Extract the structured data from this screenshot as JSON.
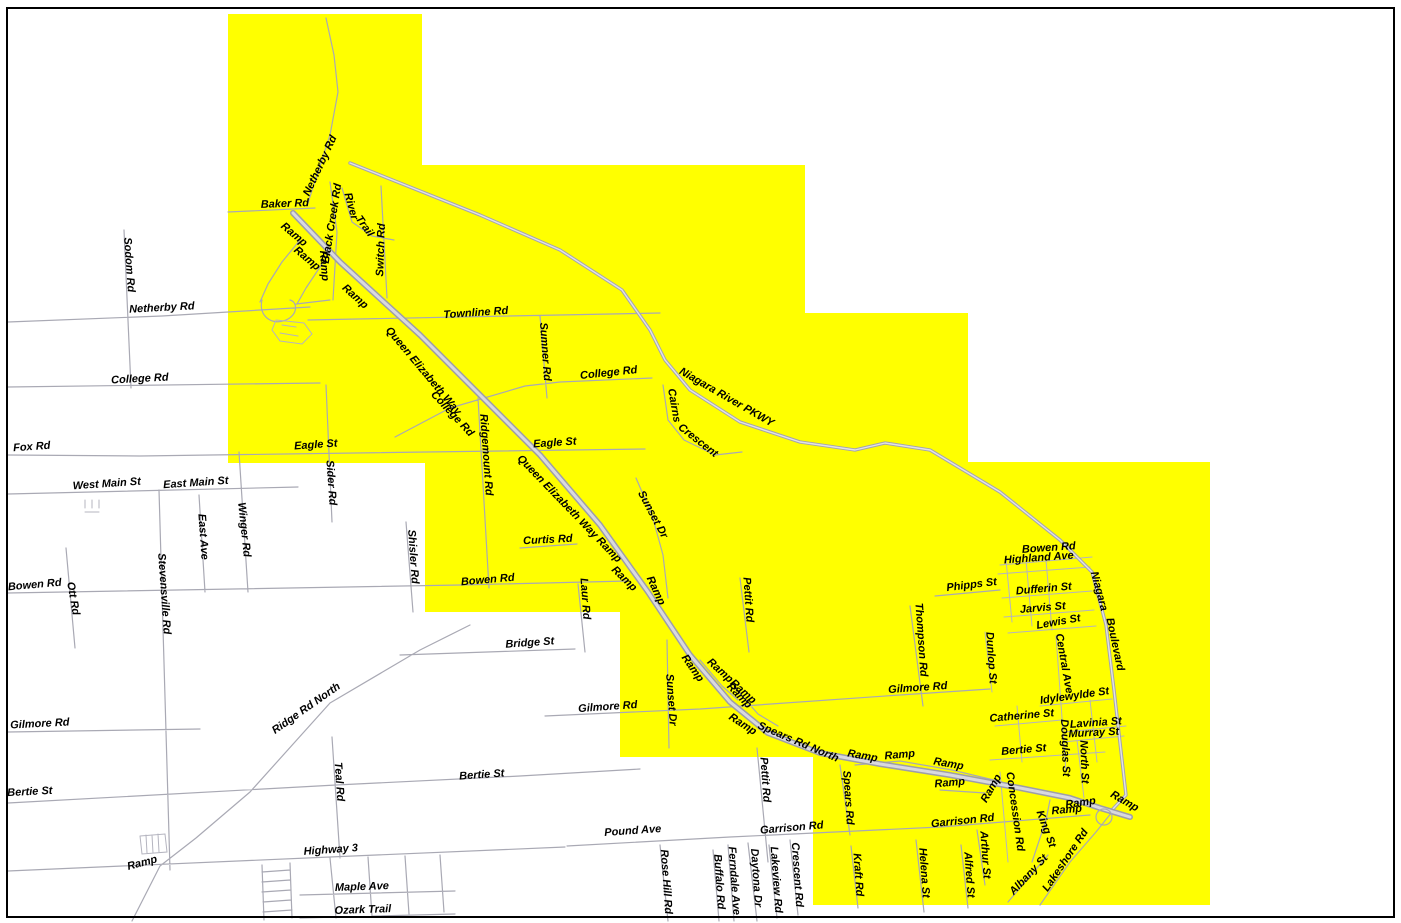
{
  "map": {
    "description": "Road map with highlighted service area",
    "colors": {
      "highlight": "#ffff00",
      "background": "#ffffff",
      "road": "#a9a9b4",
      "label": "#000000",
      "border": "#000000"
    },
    "highlight_polygon": [
      [
        228,
        14
      ],
      [
        422,
        14
      ],
      [
        422,
        165
      ],
      [
        805,
        165
      ],
      [
        805,
        313
      ],
      [
        968,
        313
      ],
      [
        968,
        462
      ],
      [
        1210,
        462
      ],
      [
        1210,
        905
      ],
      [
        813,
        905
      ],
      [
        813,
        757
      ],
      [
        620,
        757
      ],
      [
        620,
        612
      ],
      [
        425,
        612
      ],
      [
        425,
        463
      ],
      [
        228,
        463
      ]
    ],
    "labels": [
      {
        "text": "Netherby Rd",
        "x": 323,
        "y": 167,
        "rot": -65
      },
      {
        "text": "Baker Rd",
        "x": 285,
        "y": 207,
        "rot": -2
      },
      {
        "text": "Ramp",
        "x": 292,
        "y": 237,
        "rot": 40
      },
      {
        "text": "Ramp",
        "x": 305,
        "y": 261,
        "rot": 40
      },
      {
        "text": "Ramp",
        "x": 321,
        "y": 266,
        "rot": 86
      },
      {
        "text": "Ramp",
        "x": 353,
        "y": 299,
        "rot": 42
      },
      {
        "text": "Black Creek Rd",
        "x": 335,
        "y": 224,
        "rot": -81
      },
      {
        "text": "River",
        "x": 348,
        "y": 207,
        "rot": 75
      },
      {
        "text": "Trail",
        "x": 362,
        "y": 228,
        "rot": 55
      },
      {
        "text": "Switch Rd",
        "x": 384,
        "y": 250,
        "rot": -88
      },
      {
        "text": "Sodom Rd",
        "x": 126,
        "y": 265,
        "rot": 86
      },
      {
        "text": "Netherby Rd",
        "x": 162,
        "y": 311,
        "rot": -3
      },
      {
        "text": "Queen Elizabeth Way",
        "x": 421,
        "y": 373,
        "rot": 50
      },
      {
        "text": "Townline Rd",
        "x": 476,
        "y": 316,
        "rot": -4
      },
      {
        "text": "Sumner Rd",
        "x": 542,
        "y": 352,
        "rot": 86
      },
      {
        "text": "College Rd",
        "x": 140,
        "y": 382,
        "rot": -3
      },
      {
        "text": "College Rd",
        "x": 609,
        "y": 376,
        "rot": -6
      },
      {
        "text": "Niagara River PKWY",
        "x": 725,
        "y": 400,
        "rot": 30
      },
      {
        "text": "Cairns",
        "x": 671,
        "y": 406,
        "rot": 80
      },
      {
        "text": "Crescent",
        "x": 696,
        "y": 443,
        "rot": 38
      },
      {
        "text": "Eagle St",
        "x": 316,
        "y": 448,
        "rot": -4
      },
      {
        "text": "Fox Rd",
        "x": 32,
        "y": 450,
        "rot": -4
      },
      {
        "text": "West Main St",
        "x": 107,
        "y": 487,
        "rot": -4
      },
      {
        "text": "East Main St",
        "x": 196,
        "y": 486,
        "rot": -4
      },
      {
        "text": "Sider Rd",
        "x": 328,
        "y": 483,
        "rot": 86
      },
      {
        "text": "Winger Rd",
        "x": 241,
        "y": 530,
        "rot": 84
      },
      {
        "text": "East Ave",
        "x": 200,
        "y": 537,
        "rot": 86
      },
      {
        "text": "Stevensville Rd",
        "x": 161,
        "y": 594,
        "rot": 86
      },
      {
        "text": "Ott Rd",
        "x": 70,
        "y": 599,
        "rot": 80
      },
      {
        "text": "Bowen Rd",
        "x": 35,
        "y": 588,
        "rot": -5
      },
      {
        "text": "Gilmore Rd",
        "x": 40,
        "y": 727,
        "rot": -3
      },
      {
        "text": "Ridge Rd North",
        "x": 308,
        "y": 711,
        "rot": -35
      },
      {
        "text": "College Rd",
        "x": 450,
        "y": 416,
        "rot": 47
      },
      {
        "text": "Ridgemount Rd",
        "x": 483,
        "y": 455,
        "rot": 86
      },
      {
        "text": "Eagle St",
        "x": 555,
        "y": 446,
        "rot": -4
      },
      {
        "text": "Queen Elizabeth Way Ramp",
        "x": 567,
        "y": 511,
        "rot": 46
      },
      {
        "text": "Sunset Dr",
        "x": 650,
        "y": 516,
        "rot": 62
      },
      {
        "text": "Curtis Rd",
        "x": 548,
        "y": 543,
        "rot": -3
      },
      {
        "text": "Shisler Rd",
        "x": 410,
        "y": 557,
        "rot": 86
      },
      {
        "text": "Bowen Rd",
        "x": 488,
        "y": 583,
        "rot": -5
      },
      {
        "text": "Laur Rd",
        "x": 582,
        "y": 599,
        "rot": 86
      },
      {
        "text": "Ramp",
        "x": 622,
        "y": 581,
        "rot": 44
      },
      {
        "text": "Ramp",
        "x": 653,
        "y": 592,
        "rot": 65
      },
      {
        "text": "Pettit Rd",
        "x": 745,
        "y": 600,
        "rot": 86
      },
      {
        "text": "Bridge St",
        "x": 530,
        "y": 646,
        "rot": -4
      },
      {
        "text": "Ramp",
        "x": 690,
        "y": 670,
        "rot": 55
      },
      {
        "text": "Ramp",
        "x": 718,
        "y": 673,
        "rot": 42
      },
      {
        "text": "Ramp",
        "x": 741,
        "y": 694,
        "rot": 42
      },
      {
        "text": "Sunset Dr",
        "x": 668,
        "y": 700,
        "rot": 86
      },
      {
        "text": "Gilmore Rd",
        "x": 608,
        "y": 710,
        "rot": -4
      },
      {
        "text": "Thompson Rd",
        "x": 918,
        "y": 640,
        "rot": 86
      },
      {
        "text": "Phipps St",
        "x": 972,
        "y": 588,
        "rot": -7
      },
      {
        "text": "Bowen Rd",
        "x": 1049,
        "y": 551,
        "rot": -4
      },
      {
        "text": "Highland Ave",
        "x": 1039,
        "y": 561,
        "rot": -4
      },
      {
        "text": "Dufferin St",
        "x": 1044,
        "y": 592,
        "rot": -5
      },
      {
        "text": "Jarvis St",
        "x": 1043,
        "y": 611,
        "rot": -5
      },
      {
        "text": "Lewis St",
        "x": 1059,
        "y": 625,
        "rot": -10
      },
      {
        "text": "Niagara",
        "x": 1096,
        "y": 592,
        "rot": 75
      },
      {
        "text": "Boulevard",
        "x": 1112,
        "y": 645,
        "rot": 78
      },
      {
        "text": "Dunlop St",
        "x": 988,
        "y": 658,
        "rot": 86
      },
      {
        "text": "Central Ave",
        "x": 1061,
        "y": 664,
        "rot": 80
      },
      {
        "text": "Idylewylde St",
        "x": 1075,
        "y": 699,
        "rot": -8
      },
      {
        "text": "Catherine St",
        "x": 1022,
        "y": 719,
        "rot": -5
      },
      {
        "text": "Lavinia St",
        "x": 1096,
        "y": 726,
        "rot": -4
      },
      {
        "text": "Murray St",
        "x": 1094,
        "y": 736,
        "rot": -3
      },
      {
        "text": "Bertie St",
        "x": 1024,
        "y": 753,
        "rot": -5
      },
      {
        "text": "Douglas St",
        "x": 1062,
        "y": 748,
        "rot": 88
      },
      {
        "text": "North St",
        "x": 1081,
        "y": 762,
        "rot": 88
      },
      {
        "text": "Concession Rd",
        "x": 1012,
        "y": 812,
        "rot": 82
      },
      {
        "text": "Ramp",
        "x": 994,
        "y": 790,
        "rot": -60
      },
      {
        "text": "Ramp",
        "x": 1081,
        "y": 806,
        "rot": -8
      },
      {
        "text": "Ramp",
        "x": 1067,
        "y": 813,
        "rot": -5
      },
      {
        "text": "Ramp",
        "x": 1123,
        "y": 804,
        "rot": 30
      },
      {
        "text": "King St",
        "x": 1043,
        "y": 830,
        "rot": 70
      },
      {
        "text": "Albany St",
        "x": 1031,
        "y": 877,
        "rot": -47
      },
      {
        "text": "Lakeshore Rd",
        "x": 1068,
        "y": 862,
        "rot": -56
      },
      {
        "text": "Garrison Rd",
        "x": 963,
        "y": 824,
        "rot": -6
      },
      {
        "text": "Garrison Rd",
        "x": 792,
        "y": 831,
        "rot": -5
      },
      {
        "text": "Helena St",
        "x": 921,
        "y": 873,
        "rot": 86
      },
      {
        "text": "Alfred St",
        "x": 966,
        "y": 875,
        "rot": 86
      },
      {
        "text": "Arthur St",
        "x": 982,
        "y": 855,
        "rot": 86
      },
      {
        "text": "Spears Rd",
        "x": 845,
        "y": 798,
        "rot": 86
      },
      {
        "text": "Kraft Rd",
        "x": 855,
        "y": 875,
        "rot": 86
      },
      {
        "text": "Spears Rd North",
        "x": 797,
        "y": 745,
        "rot": 23
      },
      {
        "text": "Ramp",
        "x": 737,
        "y": 698,
        "rot": 46
      },
      {
        "text": "Ramp",
        "x": 741,
        "y": 727,
        "rot": 33
      },
      {
        "text": "Ramp",
        "x": 862,
        "y": 759,
        "rot": 10
      },
      {
        "text": "Ramp",
        "x": 900,
        "y": 758,
        "rot": -5
      },
      {
        "text": "Ramp",
        "x": 948,
        "y": 767,
        "rot": 10
      },
      {
        "text": "Ramp",
        "x": 950,
        "y": 786,
        "rot": -5
      },
      {
        "text": "Gilmore Rd",
        "x": 918,
        "y": 691,
        "rot": -4
      },
      {
        "text": "Pettit Rd",
        "x": 762,
        "y": 780,
        "rot": 86
      },
      {
        "text": "Bertie St",
        "x": 482,
        "y": 778,
        "rot": -4
      },
      {
        "text": "Bertie St",
        "x": 30,
        "y": 795,
        "rot": -3
      },
      {
        "text": "Teal Rd",
        "x": 336,
        "y": 782,
        "rot": 86
      },
      {
        "text": "Highway 3",
        "x": 331,
        "y": 853,
        "rot": -4
      },
      {
        "text": "Ramp",
        "x": 143,
        "y": 866,
        "rot": -15
      },
      {
        "text": "Maple Ave",
        "x": 362,
        "y": 890,
        "rot": -2
      },
      {
        "text": "Ozark Trail",
        "x": 363,
        "y": 913,
        "rot": -2
      },
      {
        "text": "Pound Ave",
        "x": 633,
        "y": 834,
        "rot": -4
      },
      {
        "text": "Rose Hill Rd",
        "x": 663,
        "y": 882,
        "rot": 86
      },
      {
        "text": "Buffalo Rd",
        "x": 716,
        "y": 882,
        "rot": 86
      },
      {
        "text": "Ferndale Ave",
        "x": 731,
        "y": 881,
        "rot": 86
      },
      {
        "text": "Daytona Dr",
        "x": 753,
        "y": 878,
        "rot": 86
      },
      {
        "text": "Lakeview Rd",
        "x": 773,
        "y": 880,
        "rot": 86
      },
      {
        "text": "Crescent Rd",
        "x": 794,
        "y": 875,
        "rot": 86
      }
    ]
  }
}
